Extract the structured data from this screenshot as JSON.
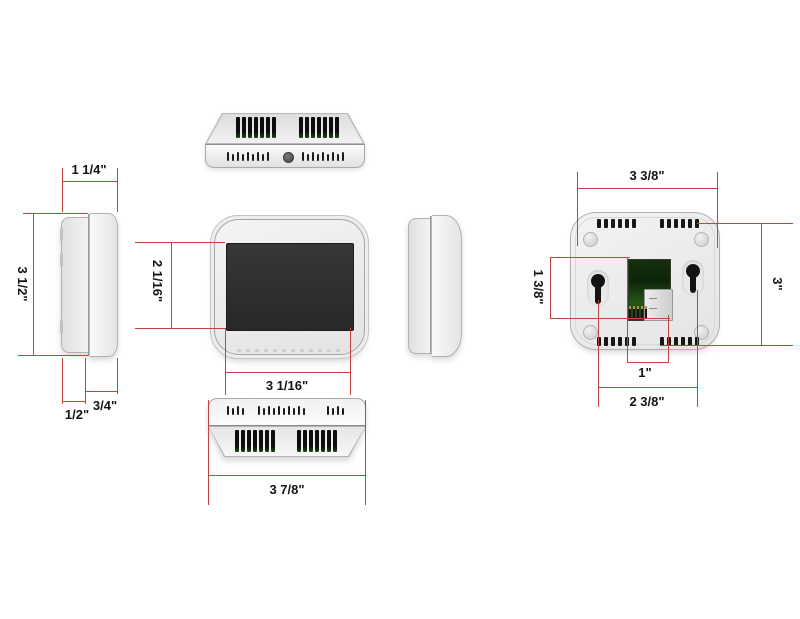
{
  "drawing": {
    "subject": "thermostat dimension drawing",
    "views": [
      "side-left",
      "top",
      "front",
      "side-right",
      "bottom",
      "back"
    ]
  },
  "dims": {
    "side_top_width": "1 1/4\"",
    "side_height": "3 1/2\"",
    "side_back_depth": "1/2\"",
    "side_front_depth": "3/4\"",
    "screen_height": "2 1/16\"",
    "screen_width": "3 1/16\"",
    "bottom_width": "3 7/8\"",
    "back_width": "3 3/8\"",
    "back_height": "3\"",
    "back_left_offset": "1 3/8\"",
    "terminal_width": "1\"",
    "keyhole_spacing": "2 3/8\""
  },
  "colors": {
    "dimension_line": "#c1453f",
    "device_body": "#efefef",
    "screen": "#2e2c2c",
    "pcb_green": "#1e4c17",
    "background": "#ffffff"
  }
}
